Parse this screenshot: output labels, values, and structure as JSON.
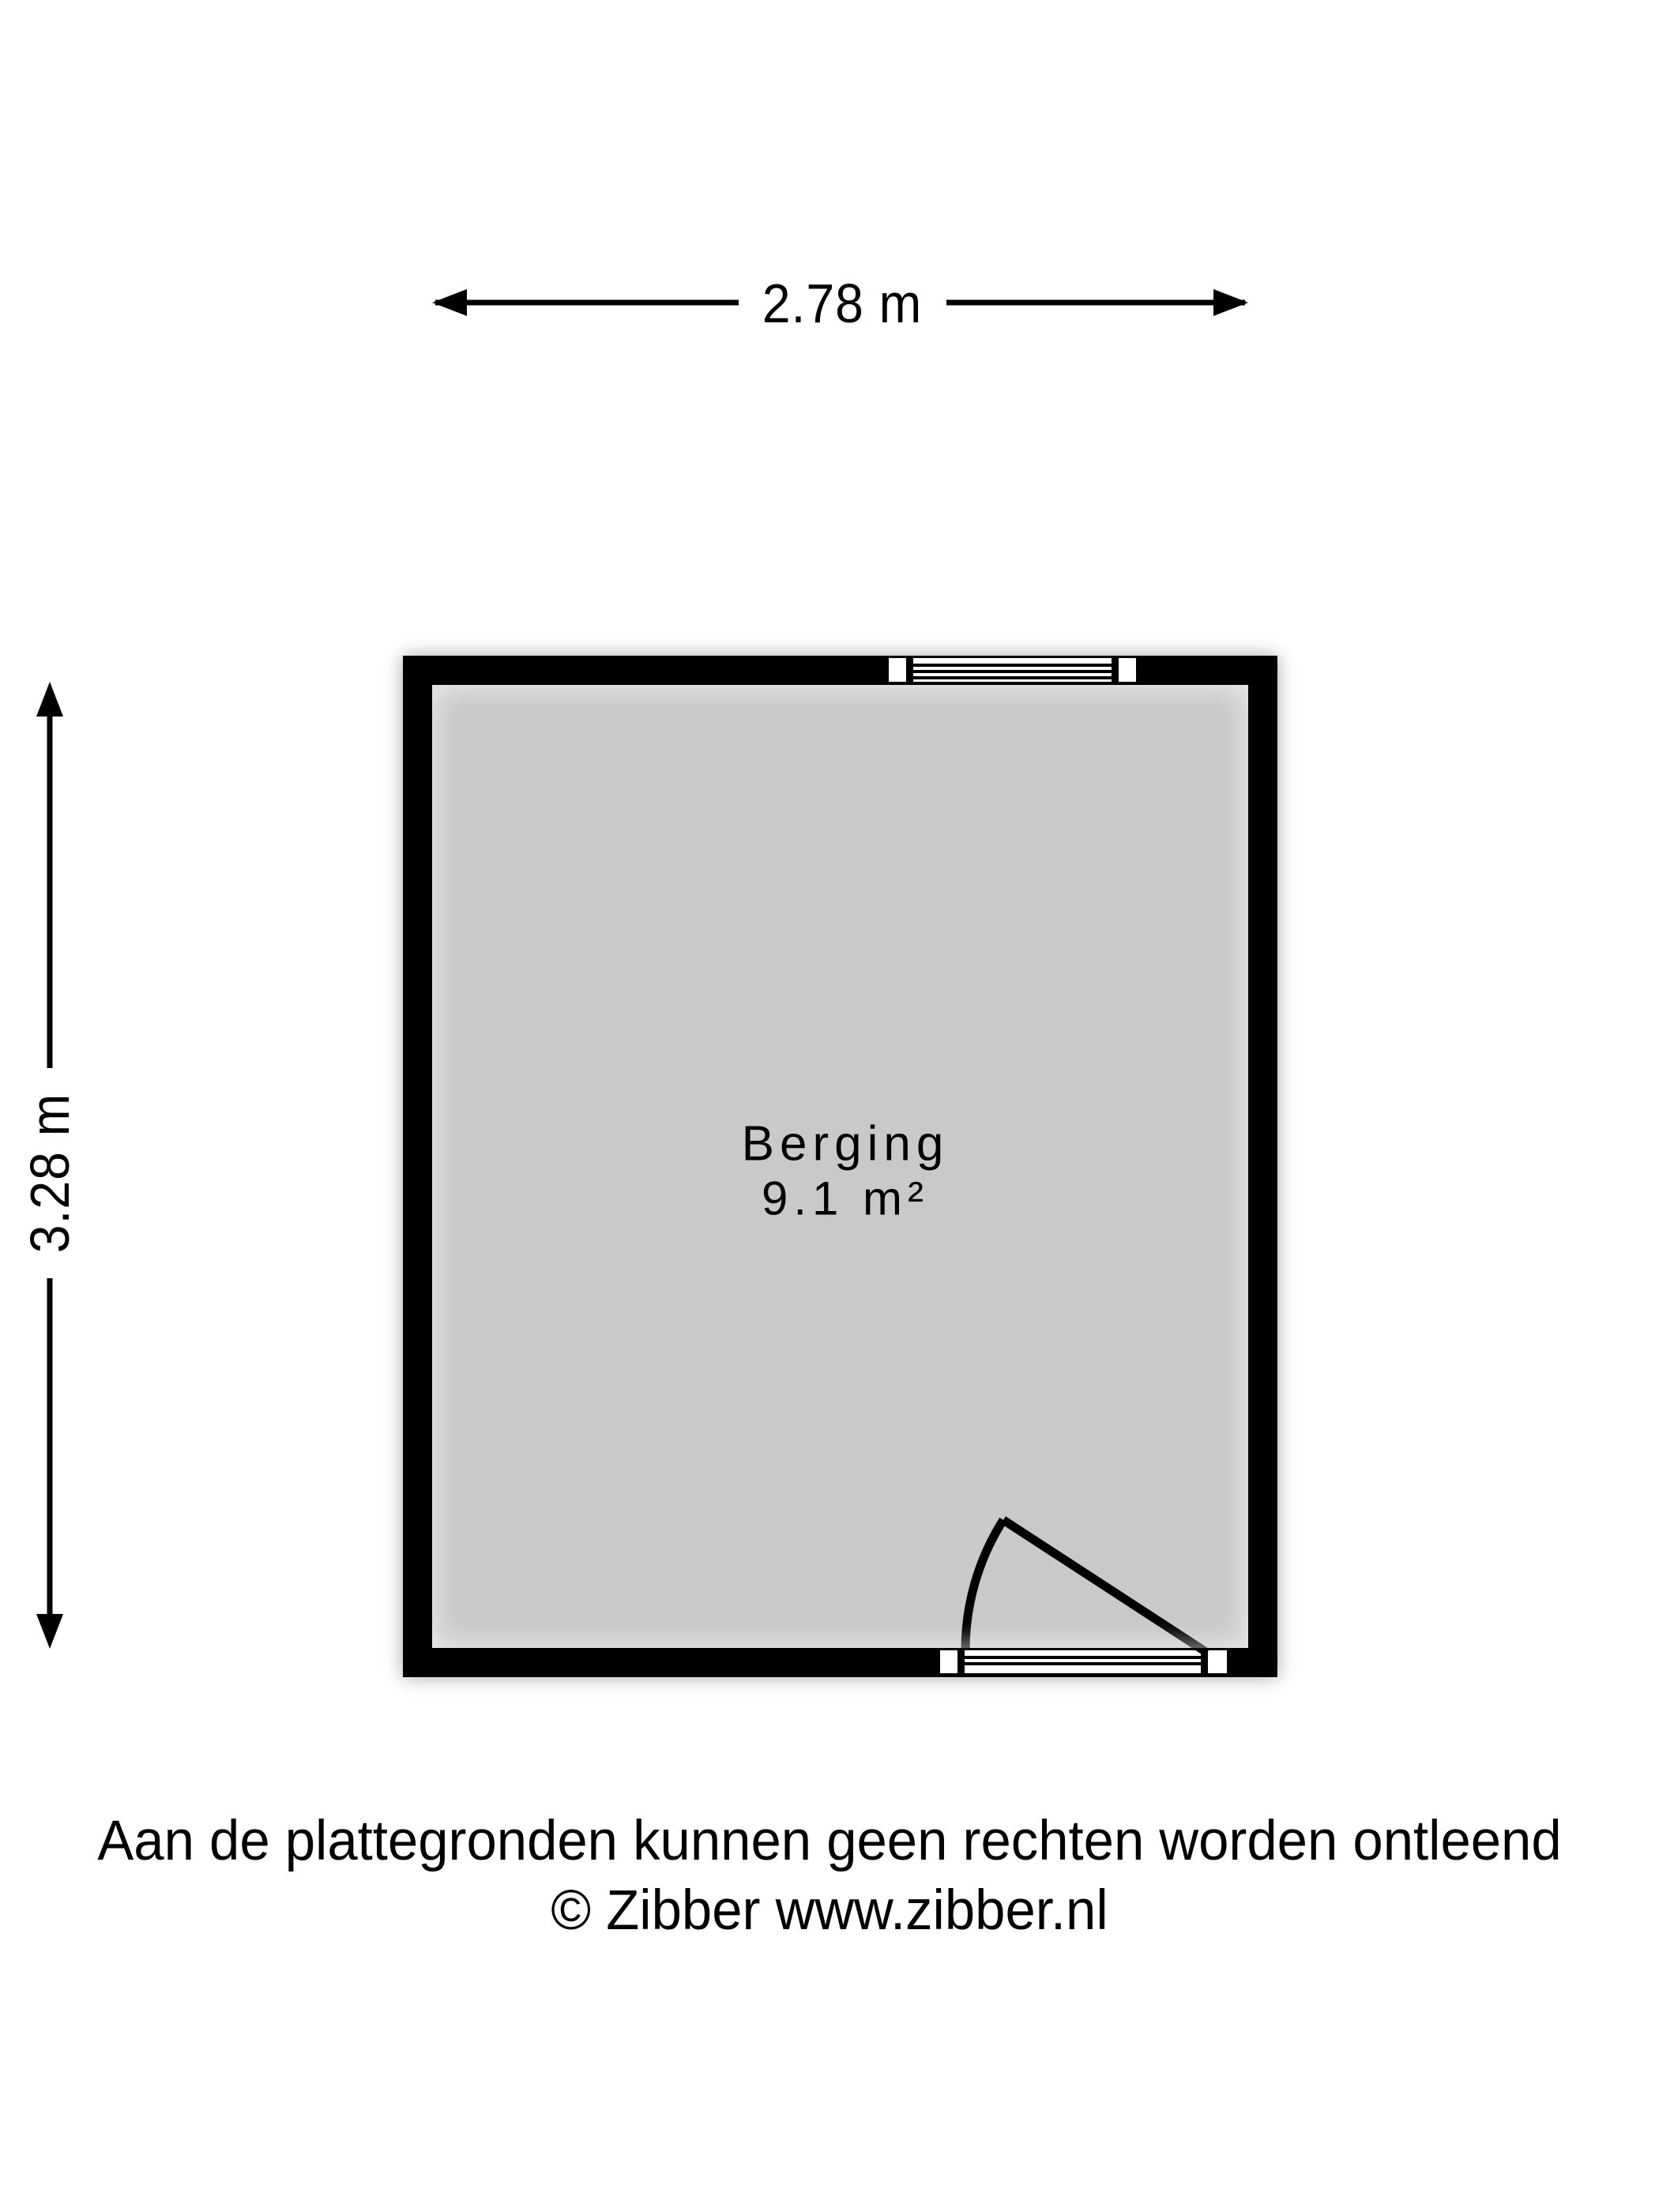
{
  "floorplan": {
    "room": {
      "name": "Berging",
      "area": "9.1 m²"
    },
    "dimensions": {
      "width": {
        "label": "2.78 m"
      },
      "height": {
        "label": "3.28 m"
      }
    },
    "colors": {
      "wall": "#000000",
      "floor": "#c9c9c9",
      "opening": "#ffffff",
      "background": "#ffffff"
    }
  },
  "footer": {
    "disclaimer": "Aan de plattegronden kunnen geen rechten worden ontleend",
    "copyright": "© Zibber www.zibber.nl"
  }
}
